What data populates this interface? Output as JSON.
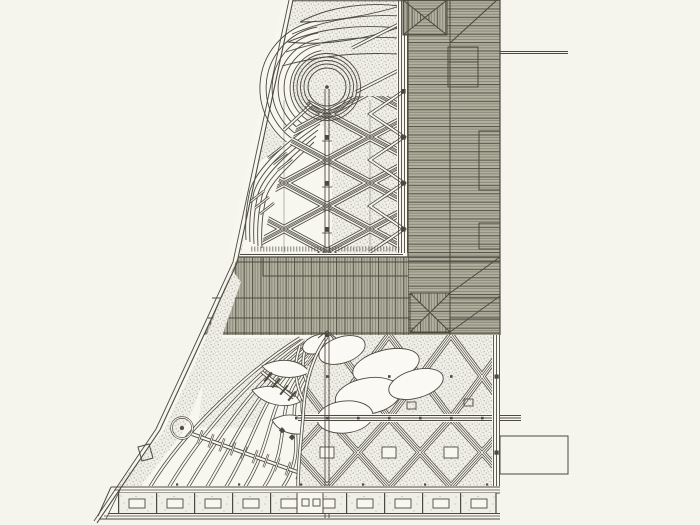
{
  "document": {
    "kind": "landscape-architecture site plan drawing",
    "visible_text": ""
  },
  "colors": {
    "paper": "#f7f6ef",
    "page_bg": "#f5f4ed",
    "ink": "#4c4a40",
    "hatch_base": "#b2b09f",
    "hatch_line": "#5a584c",
    "stipple_bg": "#f0efe7",
    "stipple_dot": "#8f8c7e",
    "white_cut": "#faf9f3"
  }
}
